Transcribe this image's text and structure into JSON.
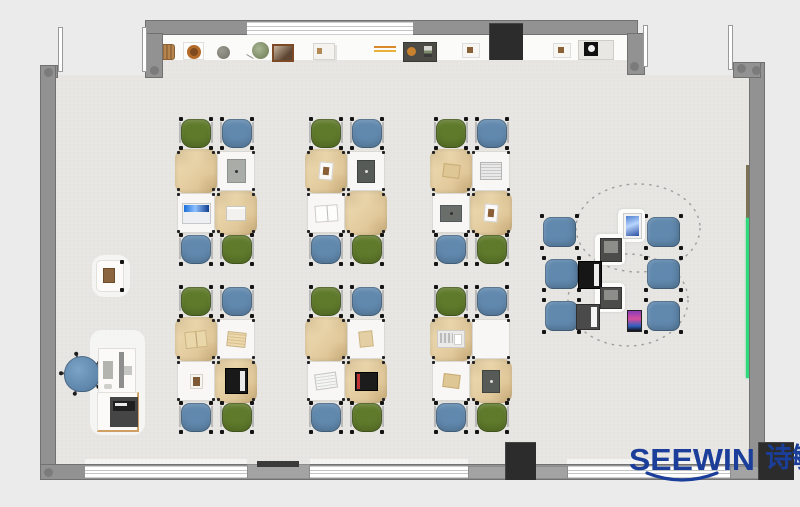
{
  "meta": {
    "title": "classroom-floor-plan-render"
  },
  "branding": {
    "logo_text": "SEEWIN",
    "logo_cjk": "诗敏",
    "logo_color": "#1a3e99"
  },
  "palette": {
    "bg": "#ebebeb",
    "floor": "#e7e6e3",
    "counter": "#fbfbfa",
    "wall": "#929292",
    "window": "#ffffff",
    "chair_green": "#5f7a2b",
    "chair_blue": "#6189ae",
    "stool_blue": "#6189ae",
    "cloth": "#e4cda0",
    "desk": "#f8f7f5",
    "board_green": "#2fd97c",
    "rail_brown": "#8a6a45",
    "rail_olive": "#7b7254",
    "block": "#2c2c2c",
    "logo_blue": "#1a3e99"
  },
  "furniture": {
    "pod_chair_colors": [
      "green",
      "blue",
      "blue",
      "green"
    ],
    "pods": [
      {
        "id": "pod-1",
        "x": 177,
        "y": 118,
        "desk_items": [
          "none",
          "tablet-gray",
          "laptop-open",
          "book-white"
        ]
      },
      {
        "id": "pod-2",
        "x": 307,
        "y": 118,
        "desk_items": [
          "card-white",
          "tablet-dark",
          "book-open",
          "none"
        ]
      },
      {
        "id": "pod-3",
        "x": 432,
        "y": 118,
        "desk_items": [
          "book-tan",
          "book-striped",
          "laptop-dark",
          "card-white"
        ]
      },
      {
        "id": "pod-4",
        "x": 177,
        "y": 286,
        "desk_items": [
          "book-open-tan",
          "newspaper-tan",
          "photo",
          "laptop-black"
        ]
      },
      {
        "id": "pod-5",
        "x": 307,
        "y": 286,
        "desk_items": [
          "none",
          "card-tan",
          "newspaper",
          "laptop-red"
        ]
      },
      {
        "id": "pod-6",
        "x": 432,
        "y": 286,
        "desk_items": [
          "keyboard",
          "none",
          "book-tan",
          "tablet-dark"
        ]
      }
    ],
    "collab_stools": [
      {
        "x": 543,
        "y": 217
      },
      {
        "x": 545,
        "y": 259
      },
      {
        "x": 545,
        "y": 301
      },
      {
        "x": 647,
        "y": 217
      },
      {
        "x": 647,
        "y": 259
      },
      {
        "x": 647,
        "y": 301
      }
    ],
    "collab_devices": [
      {
        "type": "tablet-white",
        "x": 623,
        "y": 213,
        "w": 17,
        "h": 24,
        "pad": true
      },
      {
        "type": "device-dark",
        "x": 600,
        "y": 238,
        "w": 20,
        "h": 22,
        "pad": true
      },
      {
        "type": "laptop-black",
        "x": 578,
        "y": 261,
        "w": 22,
        "h": 26,
        "pad": false
      },
      {
        "type": "device-dark",
        "x": 600,
        "y": 287,
        "w": 20,
        "h": 20,
        "pad": true
      },
      {
        "type": "laptop-white",
        "x": 576,
        "y": 304,
        "w": 22,
        "h": 24,
        "pad": false
      },
      {
        "type": "phone",
        "x": 627,
        "y": 310,
        "w": 13,
        "h": 20,
        "pad": false
      }
    ]
  },
  "shelf_items": [
    {
      "name": "basket-brown",
      "x": 159,
      "y": 44
    },
    {
      "name": "bowl-ring",
      "x": 183,
      "y": 42
    },
    {
      "name": "pot-gray",
      "x": 217,
      "y": 46
    },
    {
      "name": "plant-green",
      "x": 252,
      "y": 42
    },
    {
      "name": "photo-frame",
      "x": 272,
      "y": 44
    },
    {
      "name": "box-stack",
      "x": 313,
      "y": 43
    },
    {
      "name": "pencil-tray",
      "x": 374,
      "y": 46
    },
    {
      "name": "art-tray",
      "x": 403,
      "y": 42
    },
    {
      "name": "tray-small",
      "x": 462,
      "y": 43
    },
    {
      "name": "tray-small",
      "x": 553,
      "y": 43
    },
    {
      "name": "coffee-machine",
      "x": 578,
      "y": 40
    }
  ]
}
